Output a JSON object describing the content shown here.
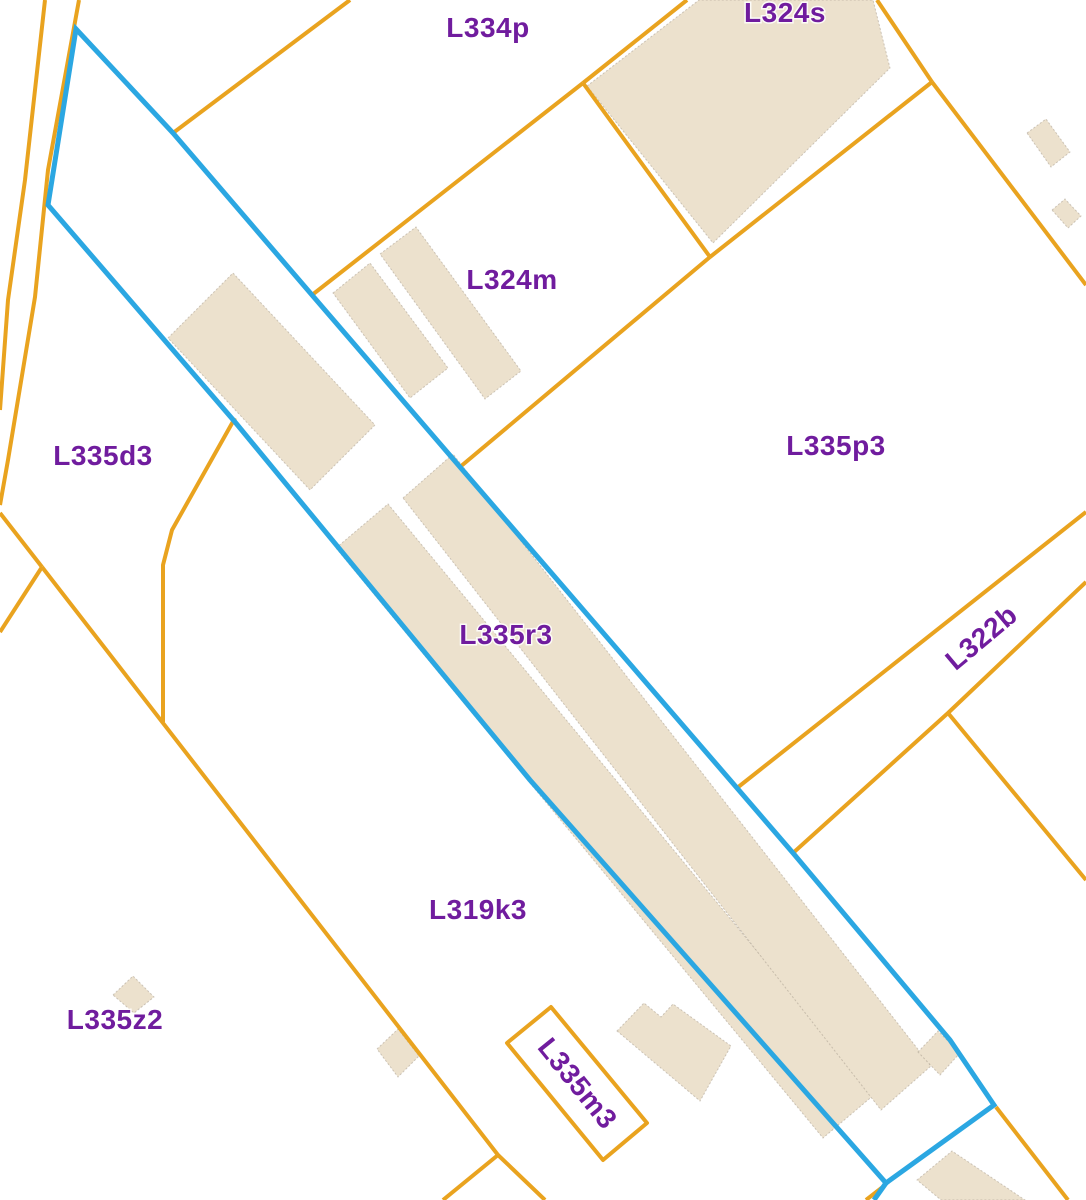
{
  "map": {
    "type": "cadastral-parcel-map",
    "selected_parcel_id": "L335r3",
    "colors": {
      "parcel_boundary_orange": "#E9A31F",
      "selected_parcel_blue": "#2BA7E2",
      "building_fill_beige": "#ECE1CD",
      "label_purple": "#701C9E",
      "background": "#FFFFFF"
    },
    "labels": [
      {
        "id": "L334p",
        "text": "L334p"
      },
      {
        "id": "L324s",
        "text": "L324s"
      },
      {
        "id": "L324m",
        "text": "L324m"
      },
      {
        "id": "L335d3",
        "text": "L335d3"
      },
      {
        "id": "L335p3",
        "text": "L335p3"
      },
      {
        "id": "L335r3",
        "text": "L335r3"
      },
      {
        "id": "L322b",
        "text": "L322b"
      },
      {
        "id": "L319k3",
        "text": "L319k3"
      },
      {
        "id": "L335z2",
        "text": "L335z2"
      },
      {
        "id": "L335m3",
        "text": "L335m3"
      }
    ]
  }
}
